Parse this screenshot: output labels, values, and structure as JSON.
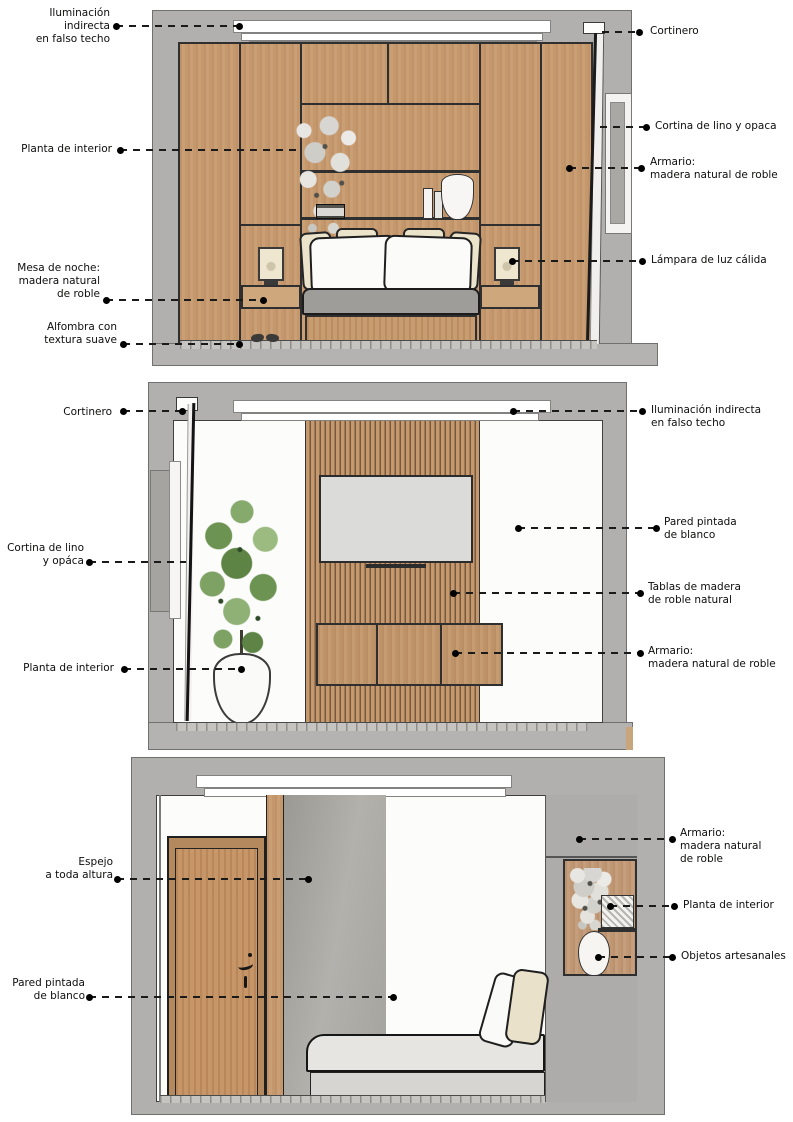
{
  "document": {
    "type": "annotated interior elevation diagram",
    "language": "es"
  },
  "palette": {
    "background": "#ffffff",
    "wall_gray": "#b1b0ae",
    "floor_gray": "#b4b3b1",
    "oak_wood": "#c79a6f",
    "door_wood": "#c39060",
    "slat_wood": "#c5996d",
    "slat_gap": "#77593d",
    "tv_screen": "#dbdbda",
    "mattress_gray": "#9e9d9a",
    "cream_pillow": "#ece3cb",
    "leaf_green": "#6c9352",
    "mirror_gray": "#a4a39e",
    "outline": "#2f2f2f",
    "text": "#0d0d0c"
  },
  "views": [
    {
      "id": "bed-wall-elevation",
      "labels_left": [
        "Iluminación indirecta\nen falso techo",
        "Planta de interior",
        "Mesa de noche:\nmadera natural\nde roble",
        "Alfombra con\ntextura suave"
      ],
      "labels_right": [
        "Cortinero",
        "Cortina de lino y opaca",
        "Armario:\nmadera natural de roble",
        "Lámpara de luz cálida"
      ]
    },
    {
      "id": "tv-wall-elevation",
      "labels_left": [
        "Cortinero",
        "Cortina de lino\ny opáca",
        "Planta de interior"
      ],
      "labels_right": [
        "Iluminación indirecta\nen falso techo",
        "Pared pintada\nde blanco",
        "Tablas de madera\nde roble natural",
        "Armario:\nmadera natural de roble"
      ]
    },
    {
      "id": "door-wall-elevation",
      "labels_left": [
        "Espejo\na toda altura",
        "Pared pintada\nde blanco"
      ],
      "labels_right": [
        "Armario:\nmadera natural\nde roble",
        "Planta de interior",
        "Objetos artesanales"
      ]
    }
  ]
}
